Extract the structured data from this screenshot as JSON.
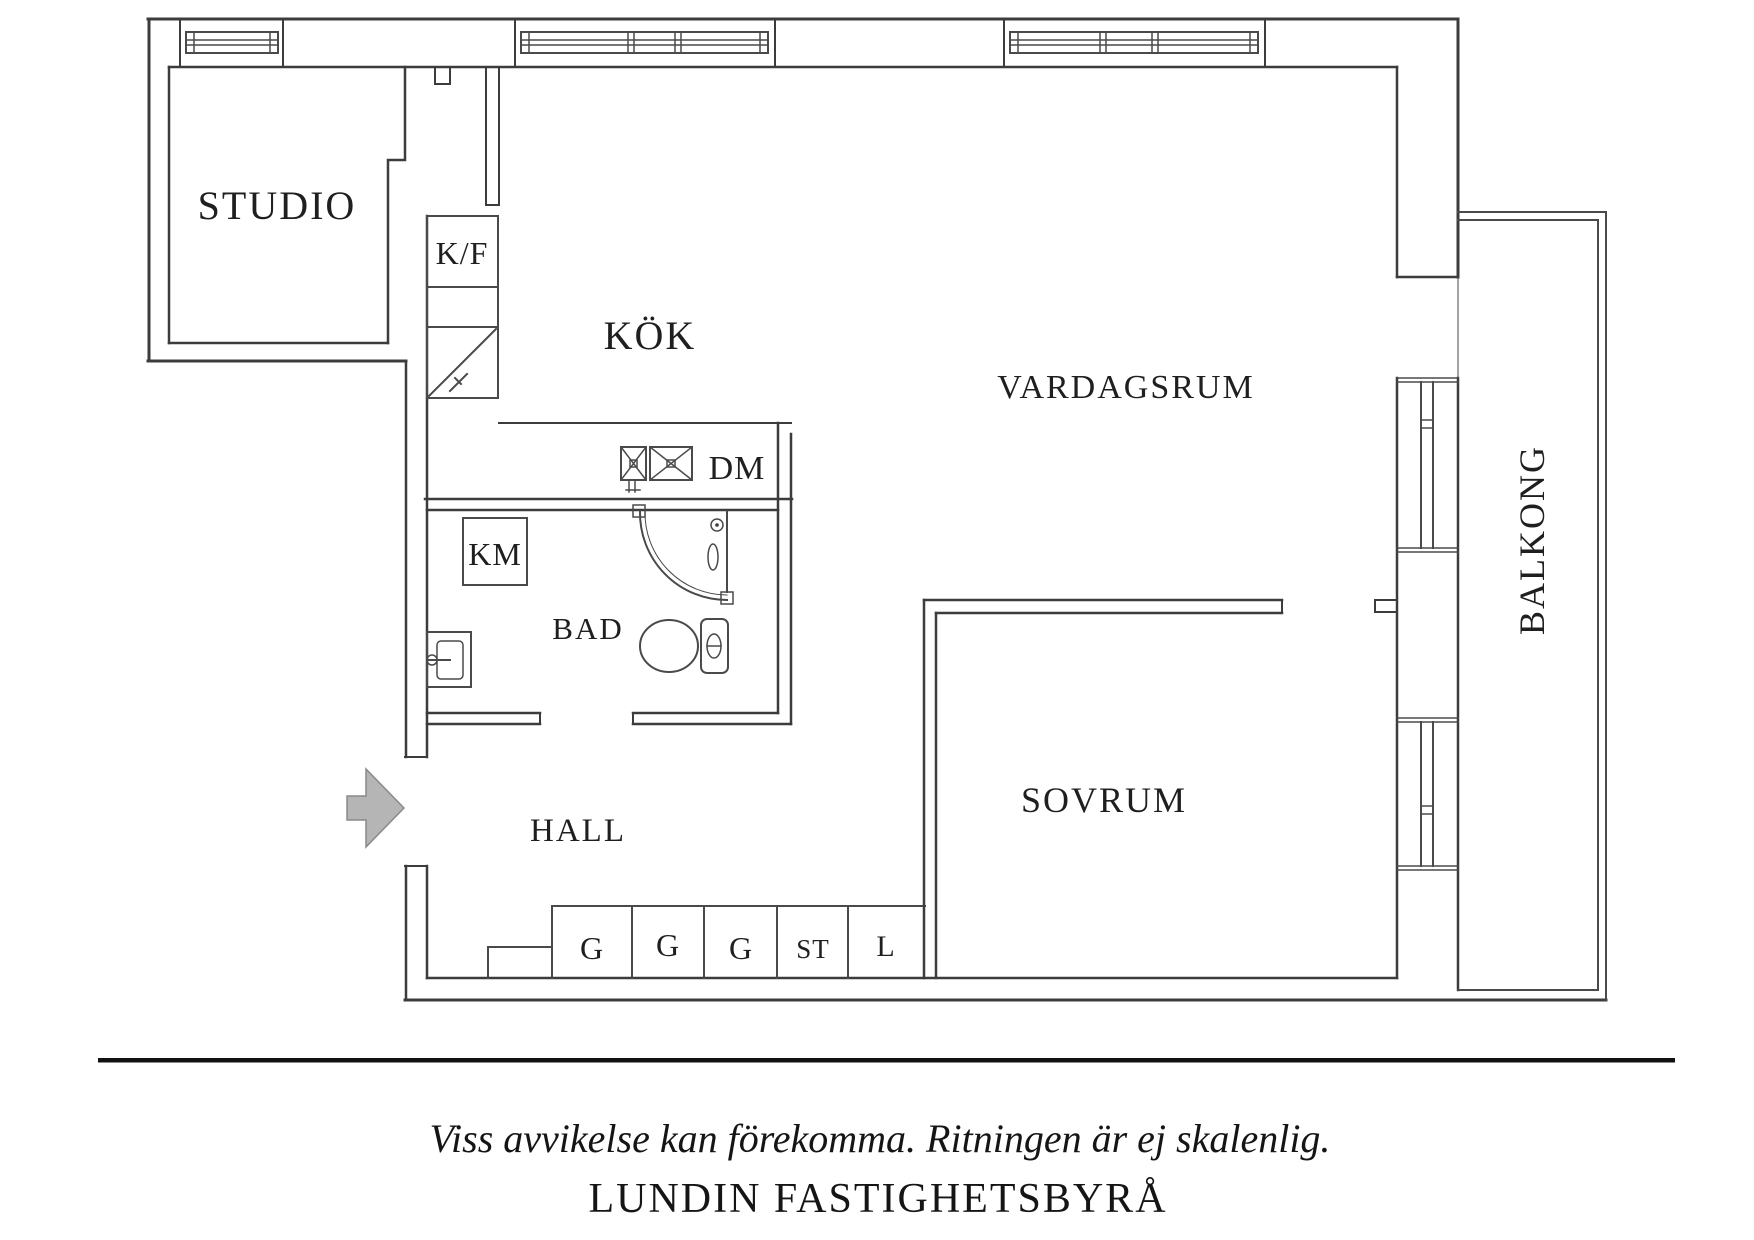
{
  "plan": {
    "rooms": {
      "studio": "STUDIO",
      "kitchen": "KÖK",
      "living_room": "VARDAGSRUM",
      "bedroom": "SOVRUM",
      "hall": "HALL",
      "bathroom": "BAD",
      "balcony": "BALKONG"
    },
    "fixtures": {
      "fridge_freezer": "K/F",
      "washing_machine": "KM",
      "dishwasher": "DM"
    },
    "closets": [
      "G",
      "G",
      "G",
      "ST",
      "L"
    ]
  },
  "footer": {
    "disclaimer": "Viss avvikelse kan förekomma. Ritningen är ej skalenlig.",
    "brand": "LUNDIN FASTIGHETSBYRÅ"
  },
  "colors": {
    "wall": "#3c3c3c",
    "text": "#1f1f1f",
    "arrow_fill": "#b5b5b5",
    "arrow_stroke": "#8a8a8a"
  }
}
